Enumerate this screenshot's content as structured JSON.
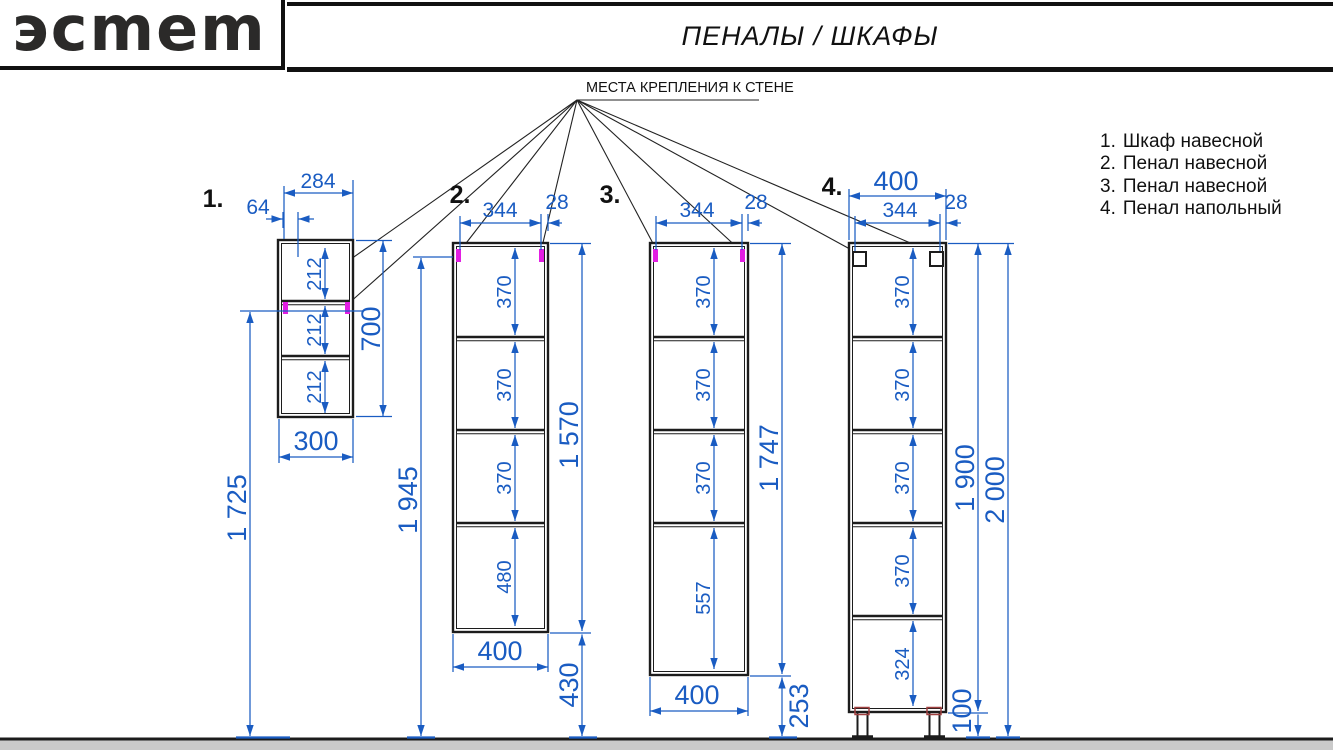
{
  "header": {
    "logo": {
      "brand": "ЭСТЕТ",
      "display_text": "эcmem"
    },
    "title": "ПЕНАЛЫ / ШКАФЫ"
  },
  "annotation": {
    "wall_mount_label": "МЕСТА КРЕПЛЕНИЯ К СТЕНЕ"
  },
  "legend": {
    "items": [
      {
        "num": "1.",
        "label": "Шкаф навесной"
      },
      {
        "num": "2.",
        "label": "Пенал навесной"
      },
      {
        "num": "3.",
        "label": "Пенал навесной"
      },
      {
        "num": "4.",
        "label": "Пенал напольный"
      }
    ]
  },
  "cabinets": [
    {
      "label": "1.",
      "dims": {
        "top_width": "284",
        "mount_offset": "64",
        "compartments": [
          "212",
          "212",
          "212"
        ],
        "width": "300",
        "height": "700",
        "mount_to_floor": "1 725"
      }
    },
    {
      "label": "2.",
      "dims": {
        "mount_span": "344",
        "mount_edge": "28",
        "compartments": [
          "370",
          "370",
          "370",
          "480"
        ],
        "width": "400",
        "height": "1 570",
        "mount_to_floor": "1 945",
        "floor_gap": "430"
      }
    },
    {
      "label": "3.",
      "dims": {
        "mount_span": "344",
        "mount_edge": "28",
        "compartments": [
          "370",
          "370",
          "370",
          "557"
        ],
        "width": "400",
        "height": "1 747",
        "floor_gap": "253"
      }
    },
    {
      "label": "4.",
      "dims": {
        "top_width": "400",
        "mount_span": "344",
        "mount_edge": "28",
        "compartments": [
          "370",
          "370",
          "370",
          "370",
          "324"
        ],
        "height": "1 900",
        "total_height": "2 000",
        "leg_height": "100"
      }
    }
  ],
  "colors": {
    "dimension_blue": "#1a5cc2",
    "mount_magenta": "#e21ee2",
    "line_black": "#1c1c1c",
    "floor_gray": "#cacaca",
    "leg_detail_red": "#a04040"
  }
}
